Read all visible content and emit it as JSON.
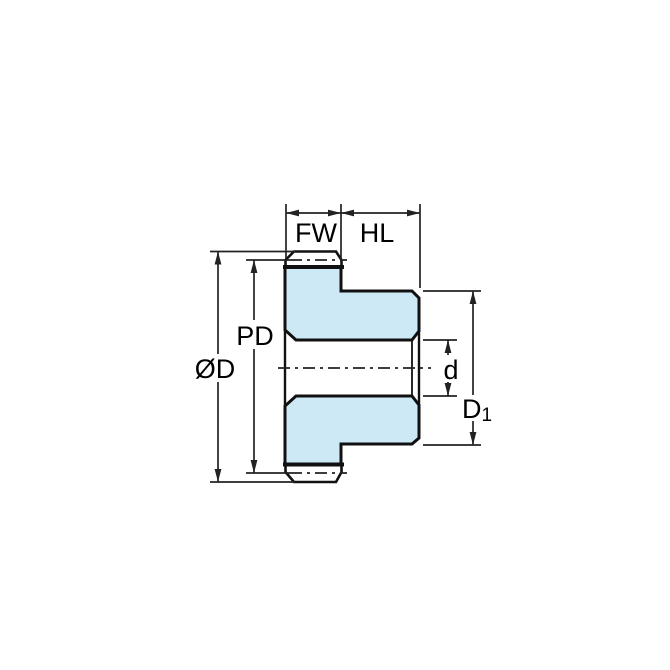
{
  "drawing": {
    "type": "gear-hub-cross-section",
    "labels": {
      "face_width": "FW",
      "hub_length": "HL",
      "pitch_diameter": "PD",
      "outside_diameter": "ØD",
      "bore_diameter": "d",
      "hub_diameter_main": "D",
      "hub_diameter_sub": "1"
    },
    "colors": {
      "part_fill": "#cde9f6",
      "outline": "#111111",
      "dimension_lines": "#222222",
      "background": "#ffffff"
    }
  }
}
